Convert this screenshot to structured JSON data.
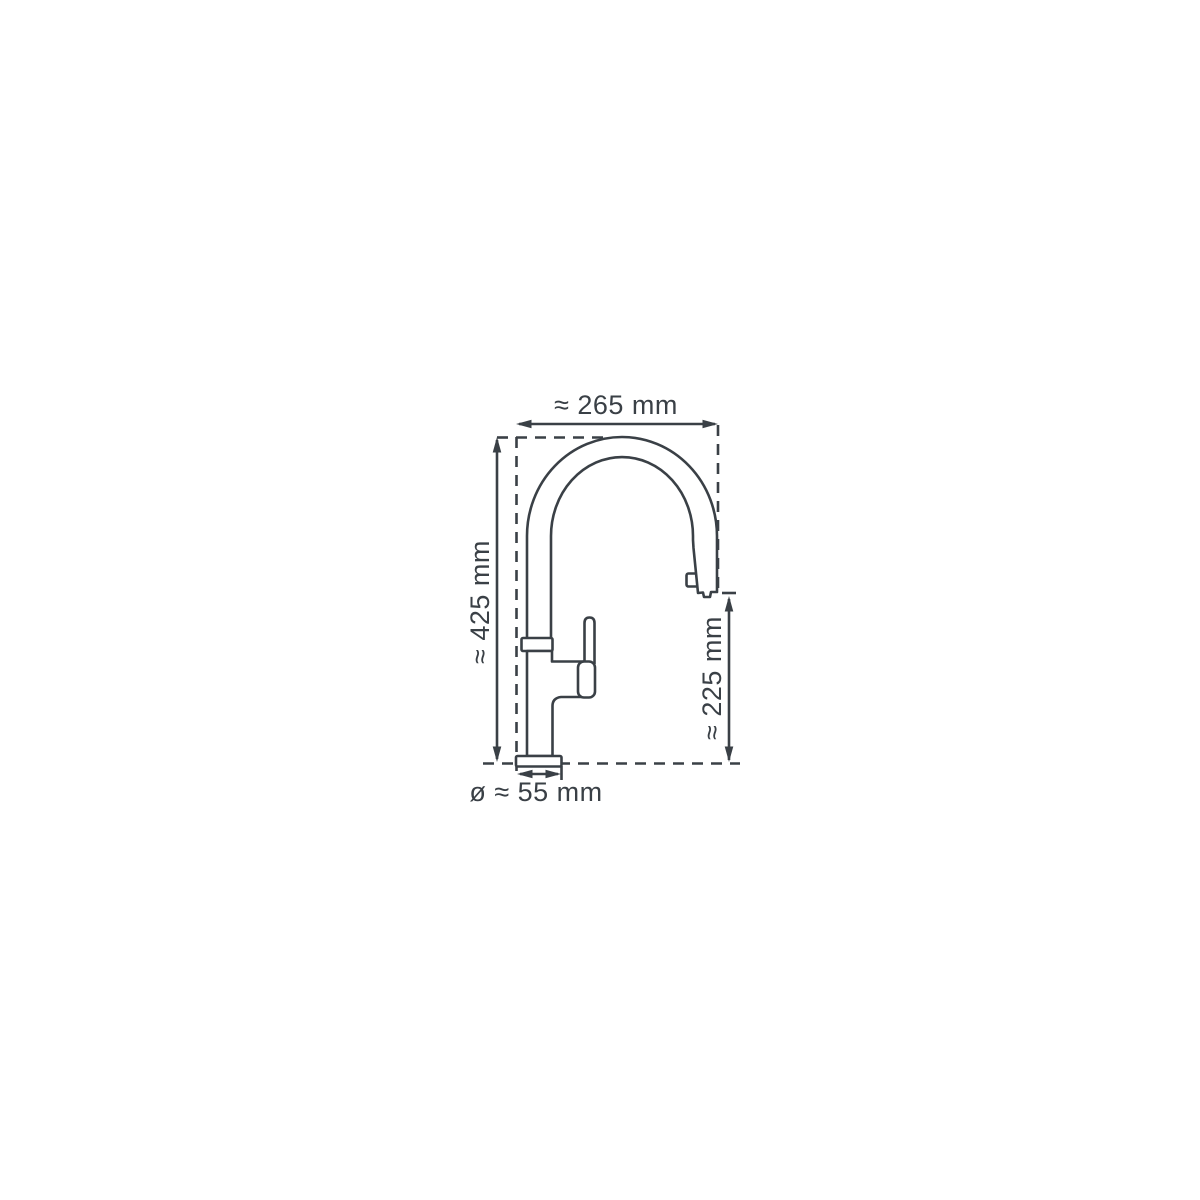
{
  "diagram": {
    "type": "technical-dimension-drawing",
    "subject": "kitchen faucet with pull-out spray head, side view",
    "background_color": "#ffffff",
    "line_color": "#3a4046",
    "dimensions": [
      {
        "id": "spout-width",
        "label": "≈ 265 mm",
        "orientation": "horizontal-top"
      },
      {
        "id": "total-height",
        "label": "≈ 425 mm",
        "orientation": "vertical-left"
      },
      {
        "id": "outlet-height",
        "label": "≈ 225 mm",
        "orientation": "vertical-right"
      },
      {
        "id": "base-diameter",
        "label": "ø ≈ 55 mm",
        "orientation": "horizontal-bottom"
      }
    ]
  }
}
